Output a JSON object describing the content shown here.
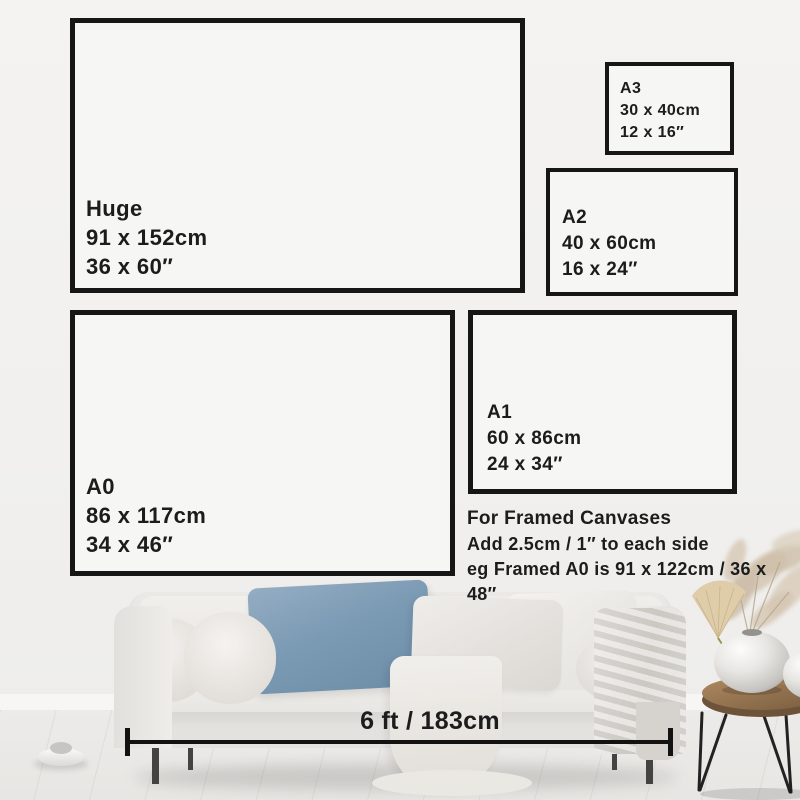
{
  "frames": [
    {
      "id": "huge",
      "name": "Huge",
      "metric": "91 x 152cm",
      "imperial": "36 x 60″"
    },
    {
      "id": "a3",
      "name": "A3",
      "metric": "30 x 40cm",
      "imperial": "12 x 16″"
    },
    {
      "id": "a2",
      "name": "A2",
      "metric": "40 x 60cm",
      "imperial": "16 x 24″"
    },
    {
      "id": "a0",
      "name": "A0",
      "metric": "86 x 117cm",
      "imperial": "34 x 46″"
    },
    {
      "id": "a1",
      "name": "A1",
      "metric": "60 x 86cm",
      "imperial": "24 x 34″"
    }
  ],
  "framed_note": {
    "title": "For Framed Canvases",
    "line1": "Add 2.5cm / 1″ to each side",
    "line2": "eg Framed A0 is 91 x 122cm / 36 x 48″"
  },
  "sofa_measurement": {
    "label": "6 ft / 183cm"
  },
  "colors": {
    "frame_border": "#161616",
    "text": "#1c1c1c",
    "wall": "#f2f1ef",
    "floor": "#e9e8e5",
    "pillow_blue": "#7b9ab4",
    "table_wood": "#8e6f4d",
    "pampas": "#d3c5b0"
  }
}
